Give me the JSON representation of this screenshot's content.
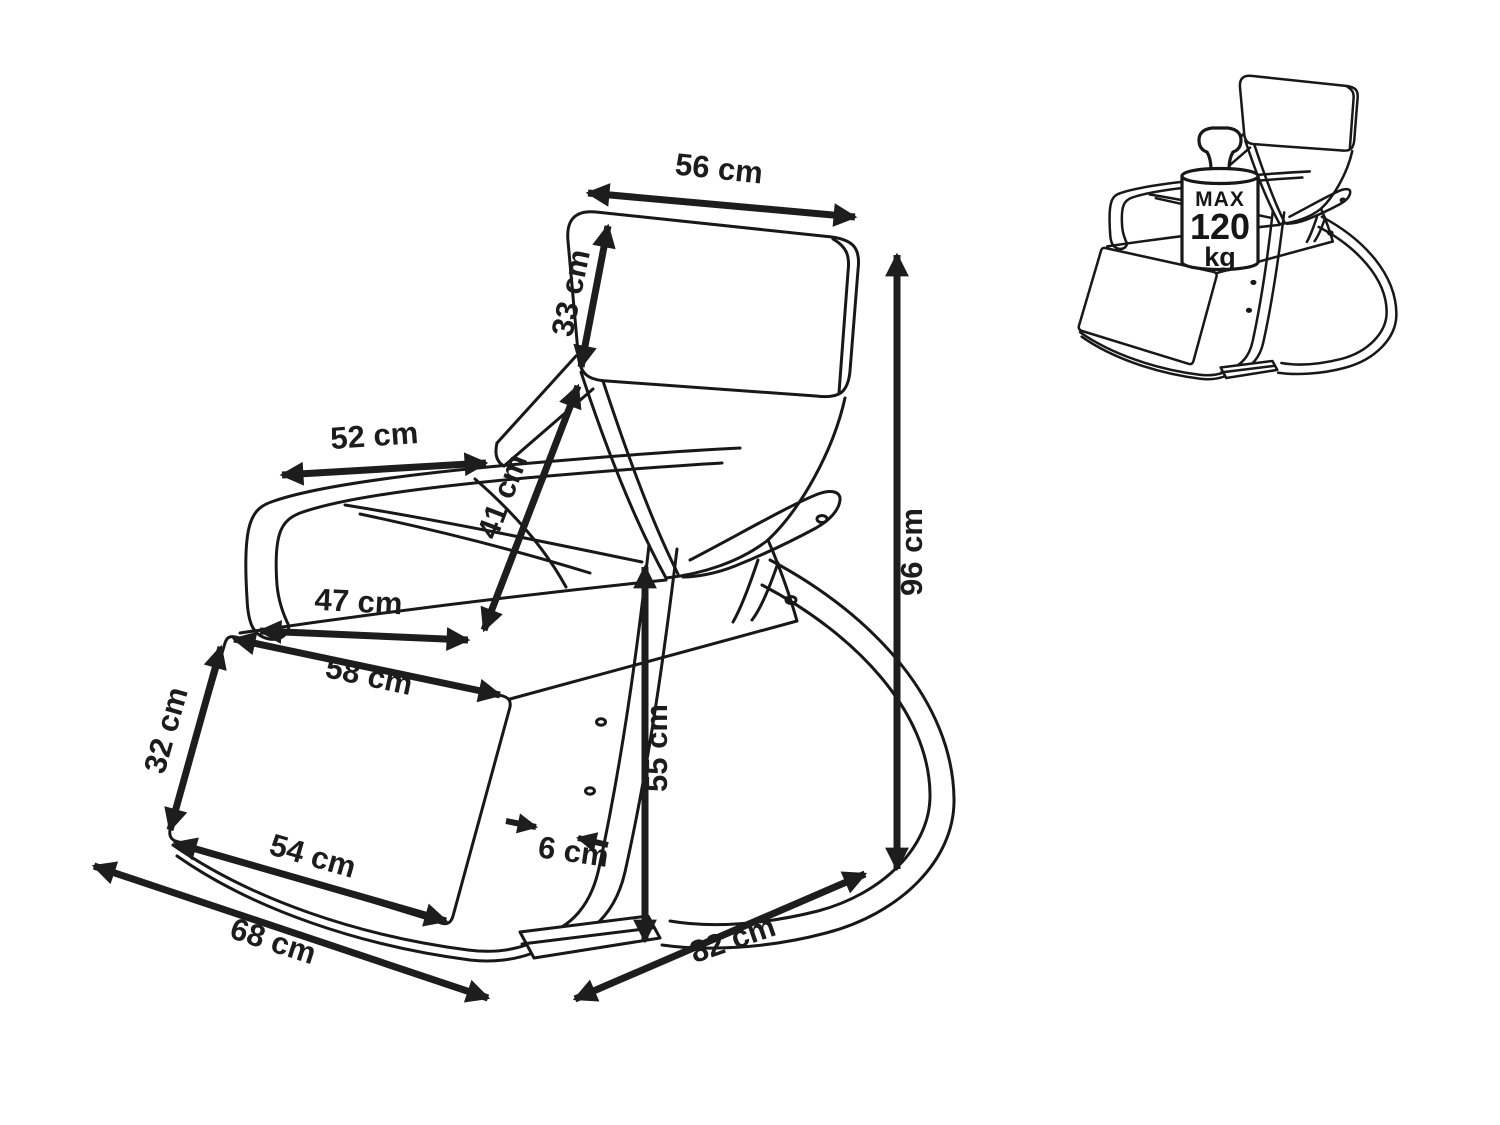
{
  "diagram": {
    "unit": "cm",
    "dimensions": [
      {
        "id": "headrest-width",
        "label": "56 cm",
        "value": 56
      },
      {
        "id": "headrest-height",
        "label": "33 cm",
        "value": 33
      },
      {
        "id": "armrest-length",
        "label": "52 cm",
        "value": 52
      },
      {
        "id": "backrest-height",
        "label": "41 cm",
        "value": 41
      },
      {
        "id": "seat-width",
        "label": "47 cm",
        "value": 47
      },
      {
        "id": "seat-depth",
        "label": "58 cm",
        "value": 58
      },
      {
        "id": "footrest-height",
        "label": "32 cm",
        "value": 32
      },
      {
        "id": "footrest-width",
        "label": "54 cm",
        "value": 54
      },
      {
        "id": "base-width",
        "label": "68 cm",
        "value": 68
      },
      {
        "id": "frame-thickness",
        "label": "6 cm",
        "value": 6
      },
      {
        "id": "armrest-height",
        "label": "55 cm",
        "value": 55
      },
      {
        "id": "base-depth",
        "label": "82 cm",
        "value": 82
      },
      {
        "id": "total-height",
        "label": "96 cm",
        "value": 96
      }
    ],
    "weight_limit": {
      "prefix": "MAX",
      "value": "120",
      "unit": "kg"
    }
  }
}
